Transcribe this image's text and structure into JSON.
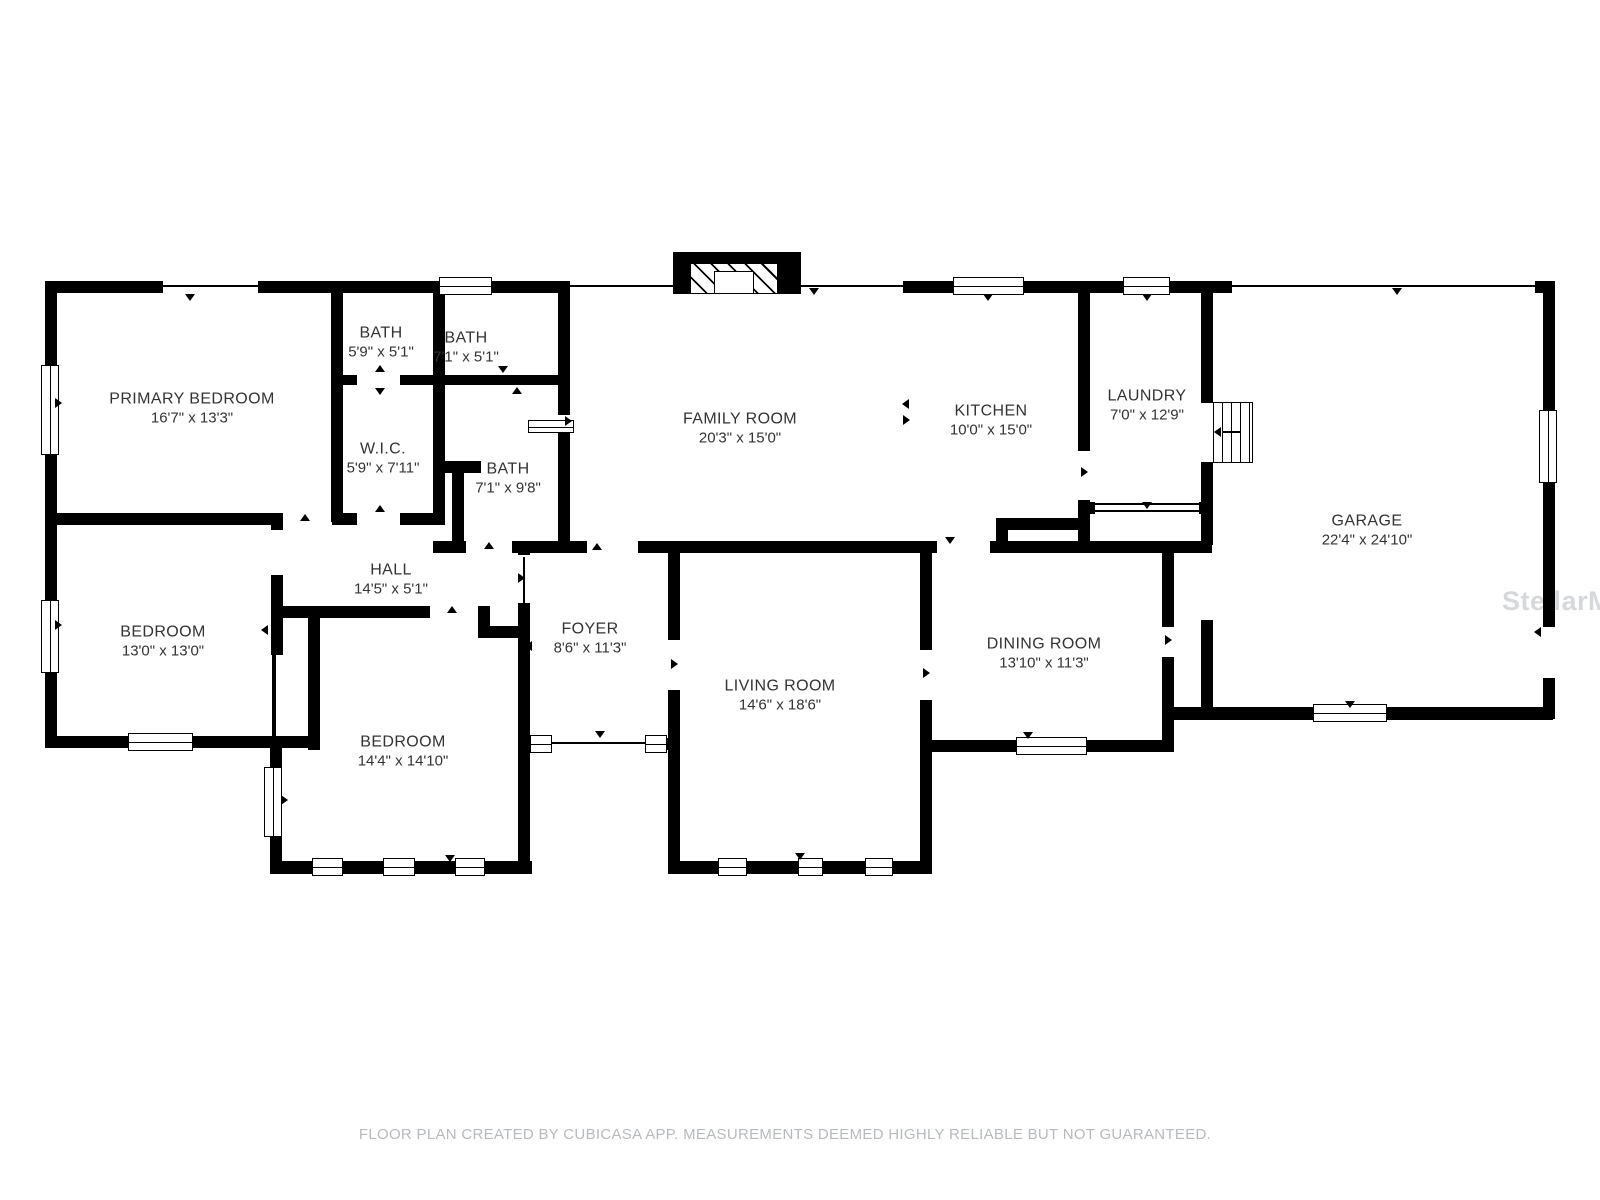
{
  "watermark": "StellarMLS",
  "disclaimer": "FLOOR PLAN CREATED BY CUBICASA APP. MEASUREMENTS DEEMED HIGHLY RELIABLE BUT NOT GUARANTEED.",
  "colors": {
    "wall": "#000000",
    "label_text": "#333333",
    "muted_text": "#b7babd",
    "watermark": "#d2d5d8"
  },
  "rooms": [
    {
      "slug": "primary-bedroom",
      "name": "PRIMARY BEDROOM",
      "dims": "16'7\" x 13'3\"",
      "cx": 192,
      "cy": 409
    },
    {
      "slug": "bath-1",
      "name": "BATH",
      "dims": "5'9\" x 5'1\"",
      "cx": 381,
      "cy": 343
    },
    {
      "slug": "bath-2",
      "name": "BATH",
      "dims": "7'1\" x 5'1\"",
      "cx": 466,
      "cy": 348
    },
    {
      "slug": "wic",
      "name": "W.I.C.",
      "dims": "5'9\" x 7'11\"",
      "cx": 383,
      "cy": 459
    },
    {
      "slug": "bath-3",
      "name": "BATH",
      "dims": "7'1\" x 9'8\"",
      "cx": 508,
      "cy": 479
    },
    {
      "slug": "family-room",
      "name": "FAMILY ROOM",
      "dims": "20'3\" x 15'0\"",
      "cx": 740,
      "cy": 429
    },
    {
      "slug": "kitchen",
      "name": "KITCHEN",
      "dims": "10'0\" x 15'0\"",
      "cx": 991,
      "cy": 421
    },
    {
      "slug": "laundry",
      "name": "LAUNDRY",
      "dims": "7'0\" x 12'9\"",
      "cx": 1147,
      "cy": 406
    },
    {
      "slug": "garage",
      "name": "GARAGE",
      "dims": "22'4\" x 24'10\"",
      "cx": 1367,
      "cy": 531
    },
    {
      "slug": "bedroom-1",
      "name": "BEDROOM",
      "dims": "13'0\" x 13'0\"",
      "cx": 163,
      "cy": 642
    },
    {
      "slug": "hall",
      "name": "HALL",
      "dims": "14'5\" x 5'1\"",
      "cx": 391,
      "cy": 580
    },
    {
      "slug": "bedroom-2",
      "name": "BEDROOM",
      "dims": "14'4\" x 14'10\"",
      "cx": 403,
      "cy": 752
    },
    {
      "slug": "foyer",
      "name": "FOYER",
      "dims": "8'6\" x 11'3\"",
      "cx": 590,
      "cy": 639
    },
    {
      "slug": "living-room",
      "name": "LIVING ROOM",
      "dims": "14'6\" x 18'6\"",
      "cx": 780,
      "cy": 696
    },
    {
      "slug": "dining-room",
      "name": "DINING ROOM",
      "dims": "13'10\" x 11'3\"",
      "cx": 1044,
      "cy": 654
    }
  ]
}
